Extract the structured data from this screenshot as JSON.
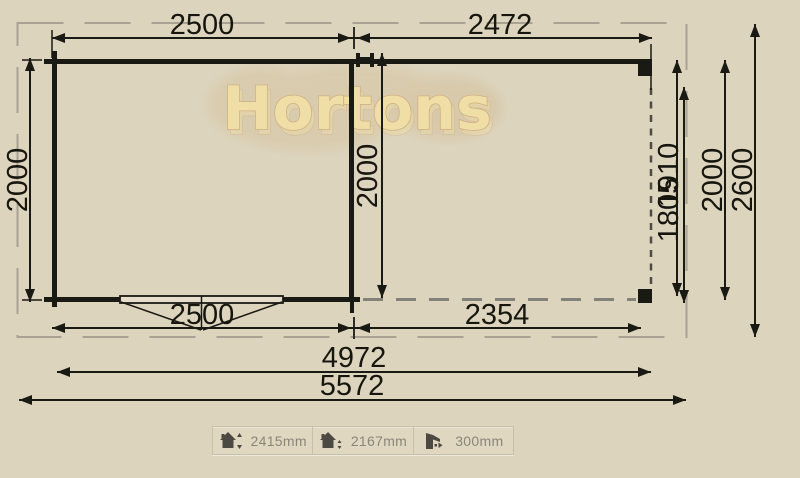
{
  "brand": {
    "watermark": "Hortons"
  },
  "plan": {
    "dim_top_left": "2500",
    "dim_top_right": "2472",
    "dim_bottom_left": "2500",
    "dim_bottom_right": "2354",
    "dim_total_inner": "4972",
    "dim_total_outer": "5572",
    "dim_left_depth": "2000",
    "dim_mid_depth": "2000",
    "dim_canopy_inner": "1805",
    "dim_canopy_outer": "1910",
    "dim_right_depth": "2000",
    "dim_right_overall": "2600"
  },
  "legend": {
    "items": [
      {
        "icon": "ridge-height-icon",
        "value": "2415mm"
      },
      {
        "icon": "eaves-height-icon",
        "value": "2167mm"
      },
      {
        "icon": "roof-overhang-icon",
        "value": "300mm"
      }
    ]
  },
  "colors": {
    "background": "#ddd4be",
    "line": "#1a1a14",
    "outer_border_gray": "#a9a191",
    "canopy_dash_dark": "#4c4c44",
    "canopy_dash_light": "#82827a",
    "watermark_text": "#f3e2a2",
    "watermark_blob": "#d6c49e",
    "legend_text": "#8b8578",
    "legend_icon": "#4c4842"
  }
}
